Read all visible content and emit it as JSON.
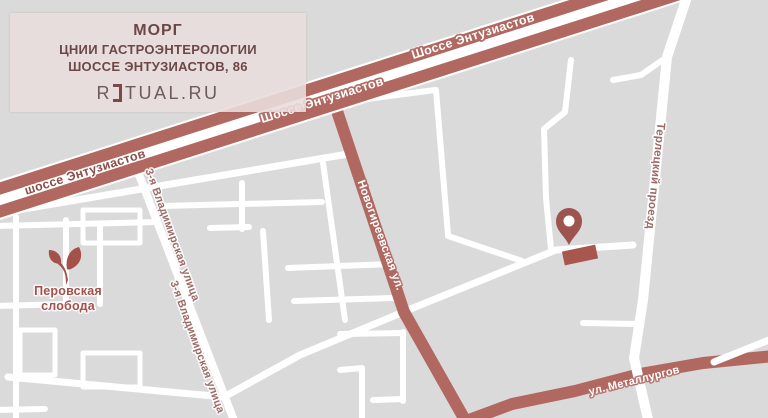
{
  "info_card": {
    "title": "МОРГ",
    "line1": "ЦНИИ ГАСТРОЭНТЕРОЛОГИИ",
    "line2": "ШОССЕ ЭНТУЗИАСТОВ, 86",
    "logo_prefix": "R",
    "logo_suffix": "TUAL.RU"
  },
  "map": {
    "labels": {
      "highway_top": "Шоссе Энтузиастов",
      "highway_mid": "Шоссе Энтузиастов",
      "highway_left": "шоссе Энтузиастов",
      "novogireevskaya": "Новогиреевская ул.",
      "vladimirskaya_1": "3-я Владимирская улица",
      "vladimirskaya_2": "3-я Владимирская улица",
      "terletsky": "Терлецкий проезд",
      "metallurgov": "ул. Металлургов",
      "perovskaya_line1": "Перовская",
      "perovskaya_line2": "слобода"
    },
    "colors": {
      "background": "#dbdada",
      "road_white": "#ffffff",
      "road_accent": "#b06861",
      "marker": "#9e544e",
      "building": "#a8574f",
      "label_dark": "#8d4d48",
      "label_muted": "#9c6b66",
      "label_green_area": "#a4504b",
      "card_background": "#e9dddd",
      "card_text": "#6b4846"
    }
  }
}
